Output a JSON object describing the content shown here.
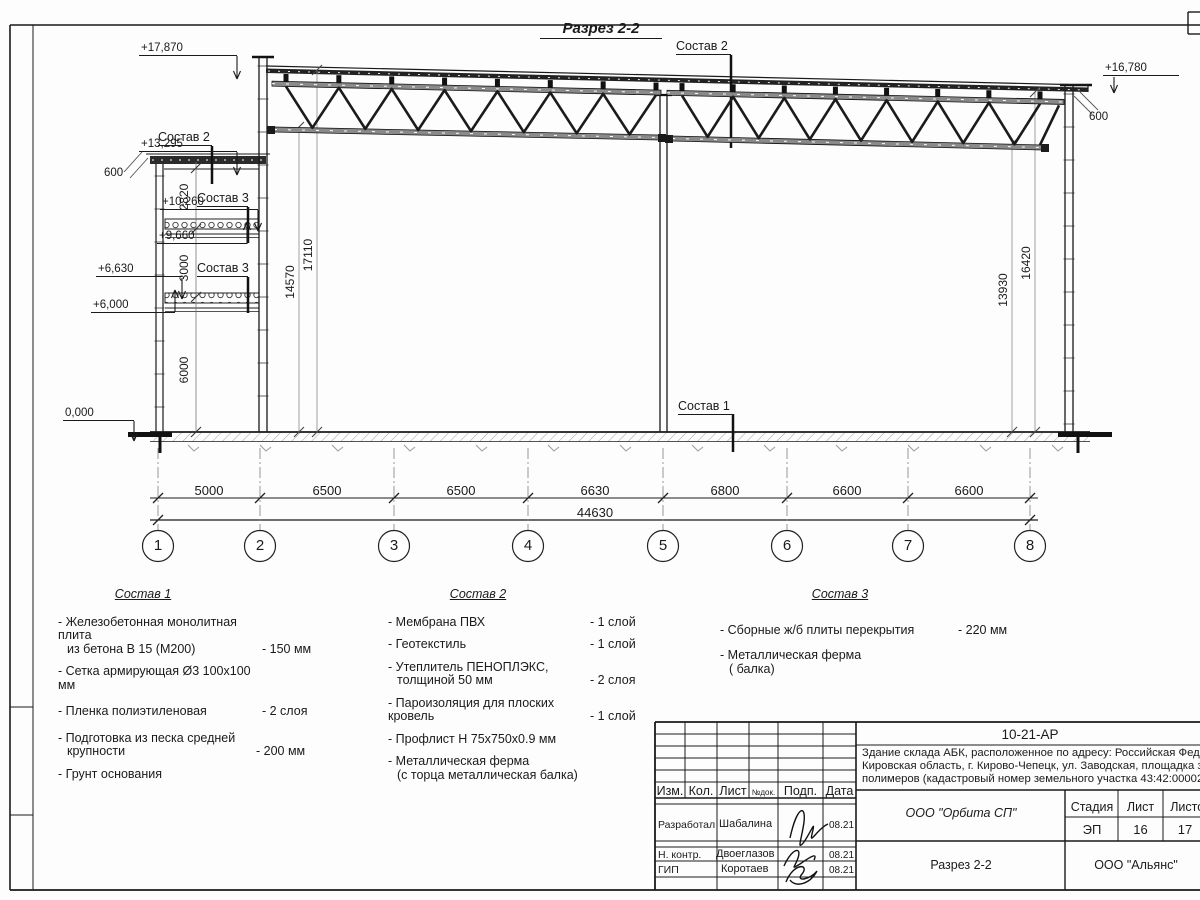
{
  "page_title": "Разрез 2-2",
  "elevations": {
    "left": [
      "+17,870",
      "+13,295",
      "+10,260",
      "+9,660",
      "+6,630",
      "+6,000",
      "0,000"
    ],
    "right": "+16,780"
  },
  "offset_dims": {
    "left": "600",
    "right": "600"
  },
  "callouts": {
    "c1": "Состав 1",
    "c2": "Состав 2",
    "c3": "Состав 3"
  },
  "vertical_dims": {
    "d2820": "2820",
    "d3000": "3000",
    "d6000": "6000",
    "d14570": "14570",
    "d17110": "17110",
    "d13930": "13930",
    "d16420": "16420"
  },
  "axis_dims": [
    "5000",
    "6500",
    "6500",
    "6630",
    "6800",
    "6600",
    "6600"
  ],
  "total_dim": "44630",
  "axes": [
    "1",
    "2",
    "3",
    "4",
    "5",
    "6",
    "7",
    "8"
  ],
  "legend1": {
    "title": "Состав 1",
    "items": [
      {
        "t": "- Железобетонная  монолитная плита",
        "t2": "из бетона В 15 (М200)",
        "v": "- 150 мм"
      },
      {
        "t": "- Сетка армирующая Ø3 100х100 мм",
        "t2": "",
        "v": ""
      },
      {
        "t": "- Пленка полиэтиленовая",
        "t2": "",
        "v": "-  2 слоя"
      },
      {
        "t": "- Подготовка из песка средней",
        "t2": "крупности",
        "v": "- 200 мм"
      },
      {
        "t": "- Грунт основания",
        "t2": "",
        "v": ""
      }
    ]
  },
  "legend2": {
    "title": "Состав 2",
    "items": [
      {
        "t": "- Мембрана ПВХ",
        "t2": "",
        "v": "- 1 слой"
      },
      {
        "t": "- Геотекстиль",
        "t2": "",
        "v": "- 1 слой"
      },
      {
        "t": "- Утеплитель ПЕНОПЛЭКС,",
        "t2": "толщиной 50 мм",
        "v": "- 2 слоя"
      },
      {
        "t": "- Пароизоляция для плоских кровель",
        "t2": "",
        "v": "- 1 слой"
      },
      {
        "t": "- Профлист Н 75х750х0.9 мм",
        "t2": "",
        "v": ""
      },
      {
        "t": "- Металлическая ферма",
        "t2": "(с торца металлическая балка)",
        "v": ""
      }
    ]
  },
  "legend3": {
    "title": "Состав 3",
    "items": [
      {
        "t": "- Сборные ж/б плиты перекрытия",
        "t2": "",
        "v": "- 220 мм"
      },
      {
        "t": "- Металлическая ферма",
        "t2": "( балка)",
        "v": ""
      }
    ]
  },
  "titleblock": {
    "code": "10-21-АР",
    "desc1": "Здание склада АБК, расположенное по адресу: Российская Федерац",
    "desc2": "Кировская область, г. Кирово-Чепецк, ул. Заводская, площадка заво",
    "desc3": "полимеров (кадастровый номер земельного участка 43:42:000022:",
    "col_izm": "Изм.",
    "col_kol": "Кол.",
    "col_list": "Лист",
    "col_ndok": "№док.",
    "col_podp": "Подп.",
    "col_data": "Дата",
    "rows": [
      {
        "role": "Разработал",
        "name": "Шабалина",
        "date": "08.21"
      },
      {
        "role": "Н. контр.",
        "name": "Двоеглазов",
        "date": "08.21"
      },
      {
        "role": "ГИП",
        "name": "Коротаев",
        "date": "08.21"
      }
    ],
    "org": "ООО \"Орбита СП\"",
    "stage_h": "Стадия",
    "sheet_h": "Лист",
    "sheets_h": "Листов",
    "stage": "ЭП",
    "sheet": "16",
    "sheets": "17",
    "drawing": "Разрез 2-2",
    "company": "ООО \"Альянс\""
  }
}
